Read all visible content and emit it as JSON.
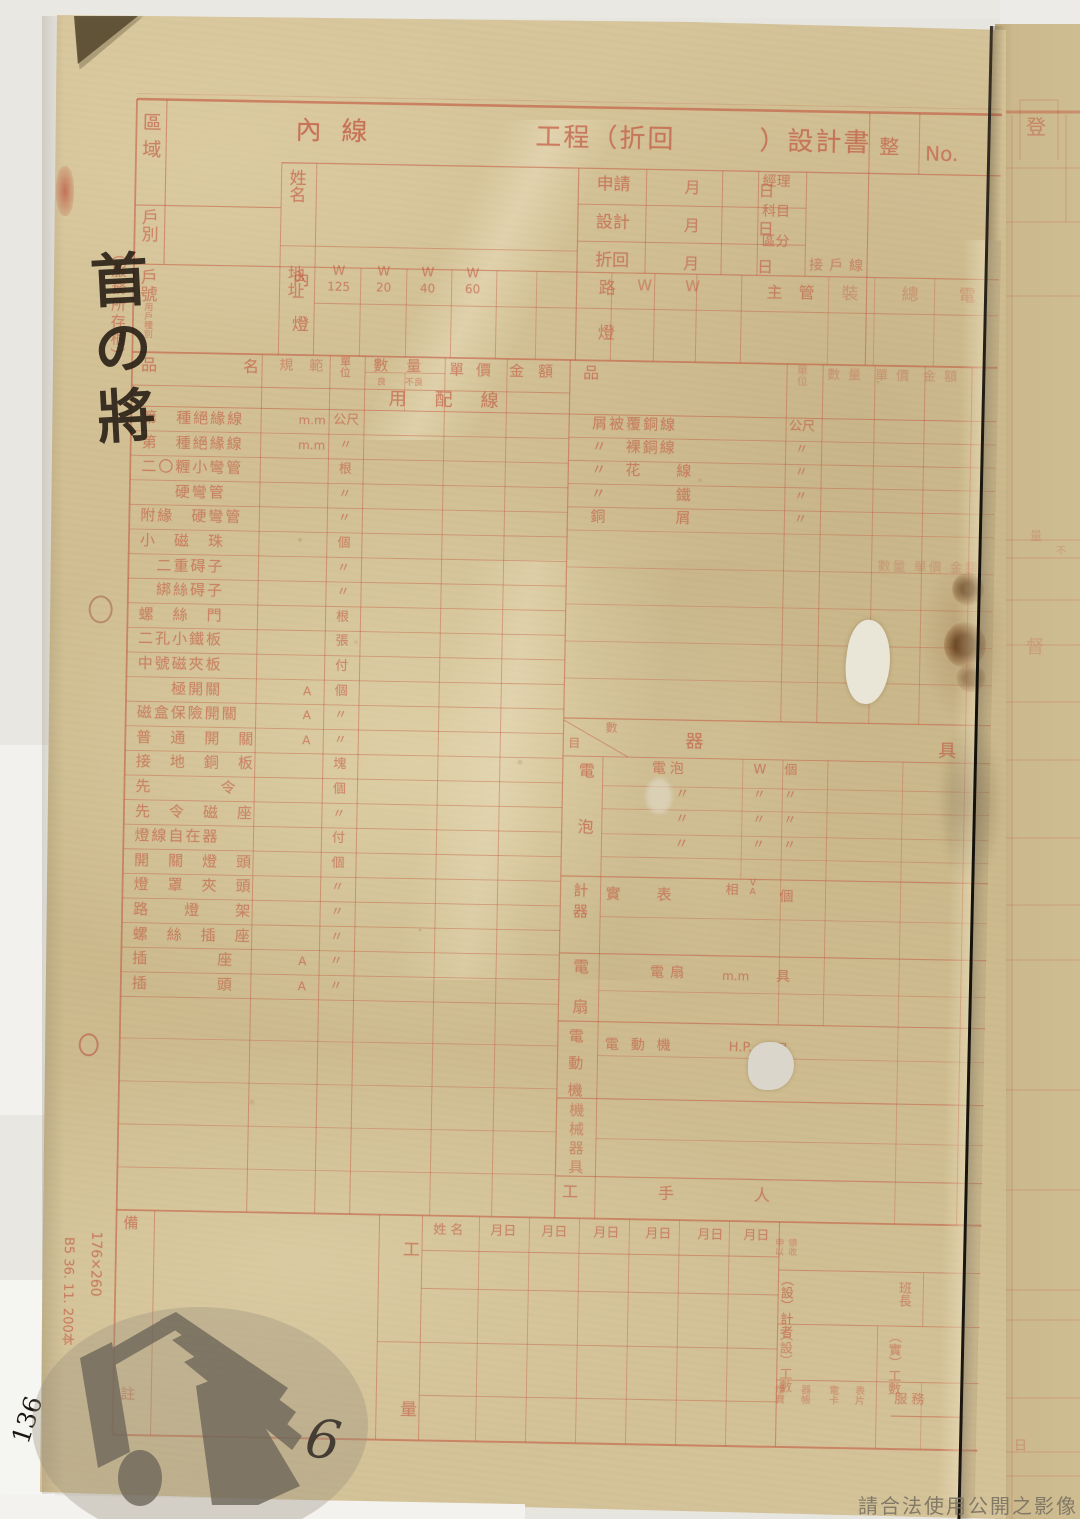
{
  "document": {
    "title_left": "內線",
    "title_right": "工程（折回　　　）設計書",
    "serial": {
      "zheng": "整",
      "no": "No."
    },
    "left_column": {
      "region": "區域",
      "household_type": "戶別",
      "household_no": "戶號",
      "household_sub": "用戶種別"
    },
    "fields": {
      "name": "姓名",
      "address": "地址"
    },
    "date_rows": [
      {
        "label": "申請",
        "month": "月",
        "day": "日"
      },
      {
        "label": "設計",
        "month": "月",
        "day": "日"
      },
      {
        "label": "折回",
        "month": "月",
        "day": "日"
      }
    ],
    "admin_labels": {
      "manager": "經理",
      "subject": "科目",
      "category": "區分",
      "service_line": "接戶線",
      "supervisor": "主　管",
      "scattered": [
        "裝",
        "總",
        "電"
      ]
    },
    "wattage": {
      "indoor": "內燈",
      "cols": [
        [
          "W",
          "125"
        ],
        [
          "W",
          "20"
        ],
        [
          "W",
          "40"
        ],
        [
          "W",
          "60"
        ]
      ],
      "street": "路燈",
      "street_cols": [
        "W",
        "W"
      ]
    }
  },
  "materials": {
    "header": {
      "item": "品",
      "name": "名",
      "spec": "規範",
      "unit": "單位",
      "qty": "數量",
      "qty_good": "良",
      "qty_bad": "不良",
      "price": "單價",
      "amount": "金額",
      "item2": "品",
      "unit2": "單位",
      "qty2": "數量",
      "price2": "單價",
      "amount2": "金額"
    },
    "section_label": "用配線",
    "showthrough": "數量 單價 金額",
    "left_rows": [
      {
        "name": "第　種絕緣線",
        "spec": "m.m",
        "unit": "公尺"
      },
      {
        "name": "第　種絕緣線",
        "spec": "m.m",
        "unit": "〃"
      },
      {
        "name": "二〇糎小彎管",
        "spec": "",
        "unit": "根"
      },
      {
        "name": "　　硬彎管",
        "spec": "",
        "unit": "〃"
      },
      {
        "name": "附緣　硬彎管",
        "spec": "",
        "unit": "〃"
      },
      {
        "name": "小　磁　珠",
        "spec": "",
        "unit": "個"
      },
      {
        "name": "　二重碍子",
        "spec": "",
        "unit": "〃"
      },
      {
        "name": "　綁絲碍子",
        "spec": "",
        "unit": "〃"
      },
      {
        "name": "螺　絲　門",
        "spec": "",
        "unit": "根"
      },
      {
        "name": "二孔小鐵板",
        "spec": "",
        "unit": "張"
      },
      {
        "name": "中號磁夾板",
        "spec": "",
        "unit": "付"
      },
      {
        "name": "　　極開關",
        "spec": "A",
        "unit": "個"
      },
      {
        "name": "磁盒保險開關",
        "spec": "A",
        "unit": "〃"
      },
      {
        "name": "普　通　開　關",
        "spec": "A",
        "unit": "〃"
      },
      {
        "name": "接　地　銅　板",
        "spec": "",
        "unit": "塊"
      },
      {
        "name": "先　　　　令",
        "spec": "",
        "unit": "個"
      },
      {
        "name": "先　令　磁　座",
        "spec": "",
        "unit": "〃"
      },
      {
        "name": "燈線自在器",
        "spec": "",
        "unit": "付"
      },
      {
        "name": "開　關　燈　頭",
        "spec": "",
        "unit": "個"
      },
      {
        "name": "燈　罩　夾　頭",
        "spec": "",
        "unit": "〃"
      },
      {
        "name": "路　　燈　　架",
        "spec": "",
        "unit": "〃"
      },
      {
        "name": "螺　絲　插　座",
        "spec": "",
        "unit": "〃"
      },
      {
        "name": "插　　　　座",
        "spec": "A",
        "unit": "〃"
      },
      {
        "name": "插　　　　頭",
        "spec": "A",
        "unit": "〃"
      }
    ],
    "right_rows": [
      {
        "name": "屑被覆銅線",
        "unit": "公尺"
      },
      {
        "name": "〃　裸銅線",
        "unit": "〃"
      },
      {
        "name": "〃　花　　線",
        "unit": "〃"
      },
      {
        "name": "〃　　　　鐵",
        "unit": "〃"
      },
      {
        "name": "銅　　　　屑",
        "unit": "〃"
      }
    ]
  },
  "equipment": {
    "corner": {
      "bl": "目",
      "tr": "數"
    },
    "title": [
      "器",
      "具"
    ],
    "bulb": {
      "label": "電泡",
      "rows": [
        [
          "電泡",
          "W",
          "個"
        ],
        [
          "〃",
          "〃",
          "〃"
        ],
        [
          "〃",
          "〃",
          "〃"
        ],
        [
          "〃",
          "〃",
          "〃"
        ]
      ]
    },
    "meter": {
      "label": "計器",
      "row": {
        "name": "實　　表",
        "phase": "相",
        "va": "V A",
        "unit": "個"
      }
    },
    "fan": {
      "label": "電扇",
      "row": {
        "name": "電扇",
        "spec": "m.m",
        "unit": "具"
      }
    },
    "motor": {
      "label": "電動機",
      "row": {
        "name": "電動機",
        "spec": "H.P.",
        "unit": "具"
      }
    },
    "machinery": {
      "label": "機械器具"
    },
    "labor": "工　手　人"
  },
  "footer": {
    "remarks": [
      "備",
      "註"
    ],
    "work": [
      "工",
      "量"
    ],
    "crew_header": [
      "姓名",
      "月日",
      "月日",
      "月日",
      "月日",
      "月日",
      "月日"
    ],
    "right": {
      "receipt": [
        "申以",
        "領收"
      ],
      "designer": "（設）計者",
      "foreman": "班長",
      "planned": "（設）工數",
      "actual": "（實）工數",
      "ledgers": [
        "燈費",
        "器帳",
        "電卡",
        "表片"
      ],
      "service": "服務"
    }
  },
  "annotations": {
    "margin_stub": "（服務所存根）",
    "handwritten_margin": "首の將",
    "handwritten_number": "6",
    "handwritten_corner": "136",
    "print_spec": "B5 36. 11. 200本",
    "print_size": "176×260",
    "watermark": "請合法使用公開之影像",
    "page2_chars": [
      "登",
      "督",
      "量",
      "不",
      "日"
    ]
  },
  "colors": {
    "ink": "#c0503a",
    "paper": "#d2c094",
    "paper2": "#cdbb8f",
    "backing": "#e7e5e0"
  }
}
